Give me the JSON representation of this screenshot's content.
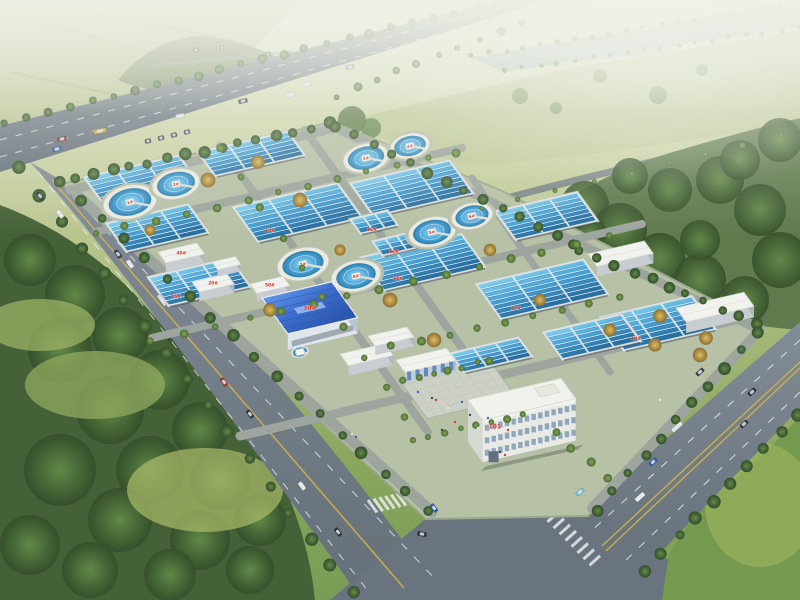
{
  "scene": {
    "type": "aerial-architectural-rendering",
    "subject": "wastewater treatment plant campus, bird's-eye view",
    "colors": {
      "haze": "#eef0e2",
      "field_light": "#c3cc9e",
      "field_mid": "#9db267",
      "grass_bright": "#7ba24c",
      "forest_dark": "#35522a",
      "forest_mid": "#47682f",
      "road": "#6e7a85",
      "road_dark": "#5c6873",
      "lane_white": "#f2f4f6",
      "lane_yellow": "#d2b23e",
      "site_ground": "#b4bfa2",
      "inner_road": "#9aa29a",
      "basin_rim": "#dfe3df",
      "basin_water_light": "#7fd0ee",
      "basin_water_dark": "#1e6aa0",
      "tank_rim": "#e9ebdf",
      "tank_water": "#3598d2",
      "roof_white": "#f2f3ee",
      "roof_blue_light": "#5b94ea",
      "roof_blue_dark": "#2350ac",
      "wall_grey": "#c6ccd0",
      "plaza": "#cbcfc3",
      "river": "#9db4c2",
      "label_red": "#d42b1f",
      "tree_dark": "#2e4a26",
      "tree_autumn": "#b08e3c"
    },
    "labels": {
      "admin_building": "101",
      "blue_workshop": "30#",
      "small_buildings": [
        "40#",
        "20#",
        "50#"
      ],
      "clarifiers": [
        "1#",
        "2#",
        "3#",
        "4#",
        "5#",
        "6#",
        "7#",
        "8#"
      ],
      "basins": [
        "14#",
        "15#",
        "16#",
        "17#",
        "18#",
        "11#",
        "12#"
      ]
    },
    "counts": {
      "clarifier_tanks": 8,
      "basin_groups": 14
    }
  }
}
